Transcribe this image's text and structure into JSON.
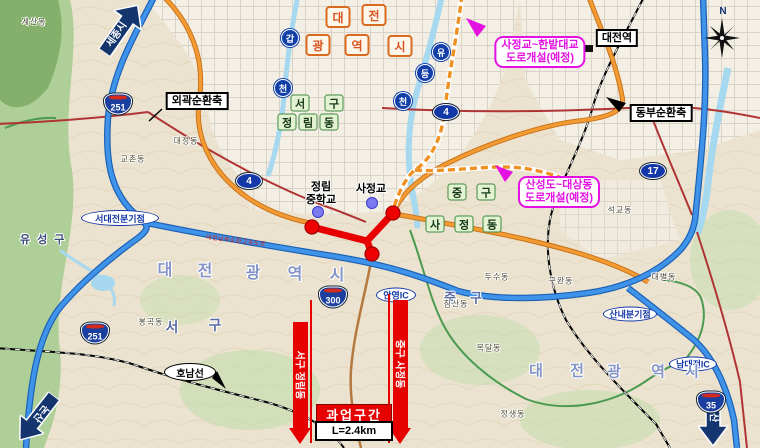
{
  "arrows": {
    "sejong": "세종시",
    "nonsan": "논산",
    "masan": "마산"
  },
  "compass": {
    "north": "N"
  },
  "axis_labels": {
    "outer_ring": "외곽순환축",
    "east_ring": "동부순환축"
  },
  "station": {
    "daejeon": "대전역"
  },
  "plans": {
    "plan1": {
      "line1": "사정교~한밭대교",
      "line2": "도로개설(예정)"
    },
    "plan2": {
      "line1": "산성도~대상동",
      "line2": "도로개설(예정)"
    }
  },
  "project": {
    "title": "과업구간",
    "length": "L=2.4km",
    "ribbon_left": "서구 정림동",
    "ribbon_right": "중구 사정동"
  },
  "city_badge": {
    "chars": [
      "대",
      "전",
      "광",
      "역",
      "시"
    ]
  },
  "city_text": {
    "chars": [
      "대",
      "전",
      "광",
      "역",
      "시"
    ]
  },
  "river_markers": {
    "gap": [
      "갑",
      "천"
    ],
    "yudeung": [
      "유",
      "등",
      "천"
    ]
  },
  "route_shields": {
    "n4": "4",
    "n17": "17",
    "e251": "251",
    "e300": "300",
    "e35": "35"
  },
  "district_boxes": {
    "seogu": [
      "서",
      "구"
    ],
    "jeongnimdong": [
      "정",
      "림",
      "동"
    ],
    "junggu": [
      "중",
      "구"
    ],
    "sajeongdong": [
      "사",
      "정",
      "동"
    ]
  },
  "district_text": {
    "yuseonggu": "유성구",
    "seogu": [
      "서",
      "구"
    ],
    "junggu": [
      "중",
      "구"
    ]
  },
  "interchanges": {
    "seodaejeon": "서대전분기점",
    "anyeong": "안영IC",
    "sannae": "산내분기점",
    "namdaejeon": "남대전IC"
  },
  "railway": {
    "honam": "호남선"
  },
  "landmarks": {
    "school_l1": "정림",
    "school_l2": "중학교",
    "bridge": "사정교"
  },
  "road_names": {
    "nambu": "대전남부순환고속도로"
  },
  "places": [
    {
      "name": "계산동"
    },
    {
      "name": "대정동"
    },
    {
      "name": "교촌동"
    },
    {
      "name": "봉곡동"
    },
    {
      "name": "두수동"
    },
    {
      "name": "구완동"
    },
    {
      "name": "목달동"
    },
    {
      "name": "정생동"
    },
    {
      "name": "대별동"
    },
    {
      "name": "침산동"
    },
    {
      "name": "석교동"
    }
  ],
  "palette": {
    "project_red": "#e60000",
    "plan_magenta": "#e312e3",
    "expressway_blue": "#3f93e8",
    "arterial_orange": "#f29a33",
    "navy_arrow": "#14356e",
    "shield_blue": "#1a3f9e",
    "route_oval_blue": "#1538a8",
    "green_box_border": "#3e8a3e",
    "badge_orange": "#d96b1f",
    "city_text_blue": "#8494c6"
  }
}
